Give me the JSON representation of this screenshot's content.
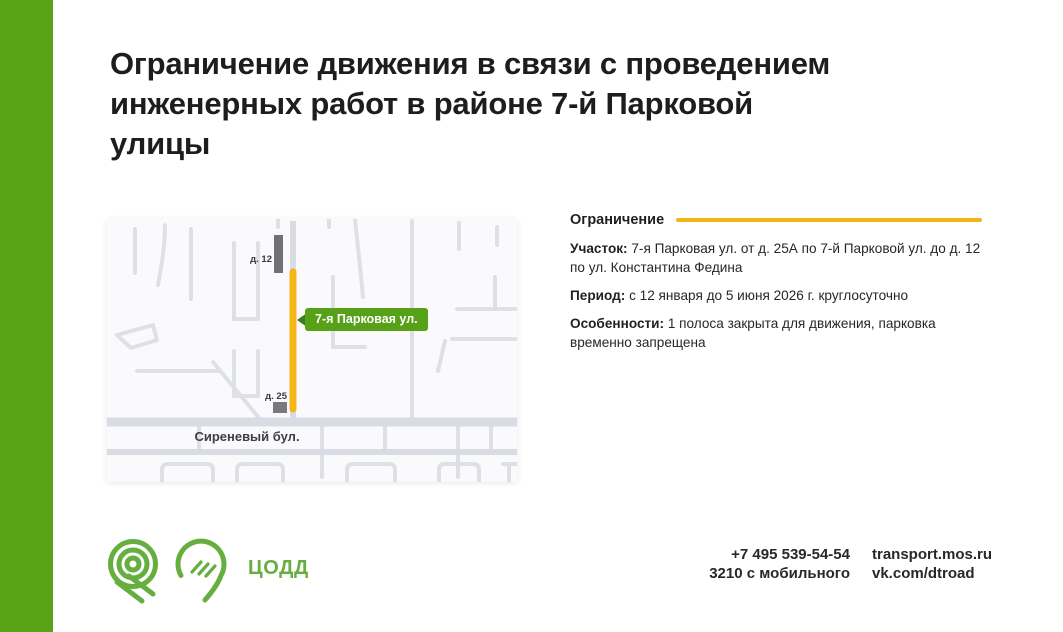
{
  "colors": {
    "brand_green": "#58a316",
    "logo_green": "#67ae40",
    "accent_yellow": "#f5b517",
    "title_text": "#1d1d1f",
    "map_road_gray": "#dde0e5",
    "building_gray": "#707176"
  },
  "title": {
    "lines": [
      "Ограничение движения в связи с проведением",
      "инженерных работ в районе 7-й Парковой",
      "улицы"
    ]
  },
  "info": {
    "heading": "Ограничение",
    "rows": [
      {
        "label": "Участок:",
        "text": "7-я Парковая ул. от д. 25А по 7-й Парковой ул. до д. 12 по ул. Константина Федина"
      },
      {
        "label": "Период:",
        "text": "с 12 января до 5 июня 2026 г. круглосуточно"
      },
      {
        "label": "Особенности:",
        "text": "1 полоса закрыта для движения, парковка временно запрещена"
      }
    ]
  },
  "map": {
    "street_label": "7-я Парковая ул.",
    "building_top_label": "д. 12",
    "building_bottom_label": "д. 25",
    "boulevard_label": "Сиреневый бул."
  },
  "footer": {
    "org_name": "ЦОДД",
    "phone_main": "+7 495 539-54-54",
    "phone_mobile": "3210 с мобильного",
    "website": "transport.mos.ru",
    "social": "vk.com/dtroad"
  }
}
